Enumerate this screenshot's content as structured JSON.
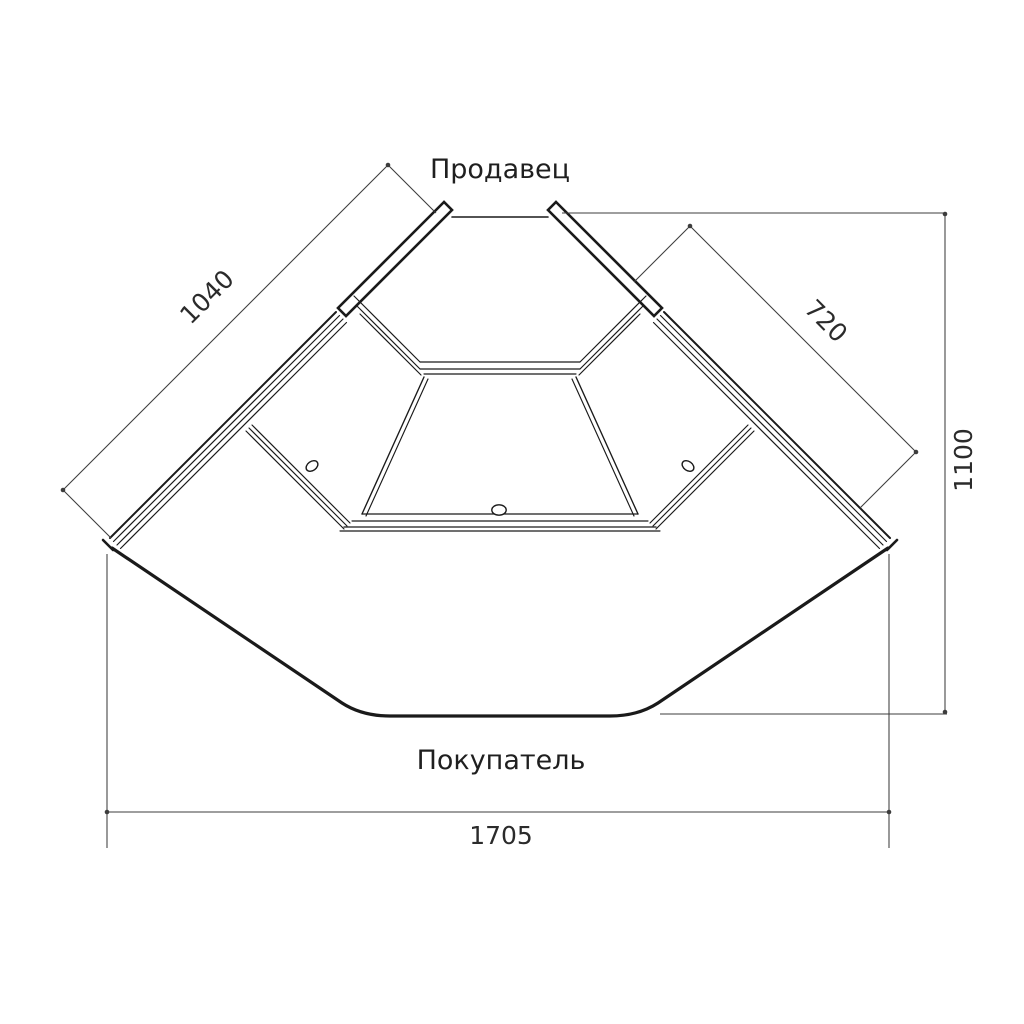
{
  "drawing": {
    "top_label": "Продавец",
    "bottom_label": "Покупатель"
  },
  "dimensions": {
    "left_glass": "1040",
    "right_glass": "720",
    "depth": "1100",
    "front_width": "1705"
  },
  "colors": {
    "object_line": "#1a1a1a",
    "dimension_line": "#3d3d3d",
    "background": "#ffffff"
  }
}
